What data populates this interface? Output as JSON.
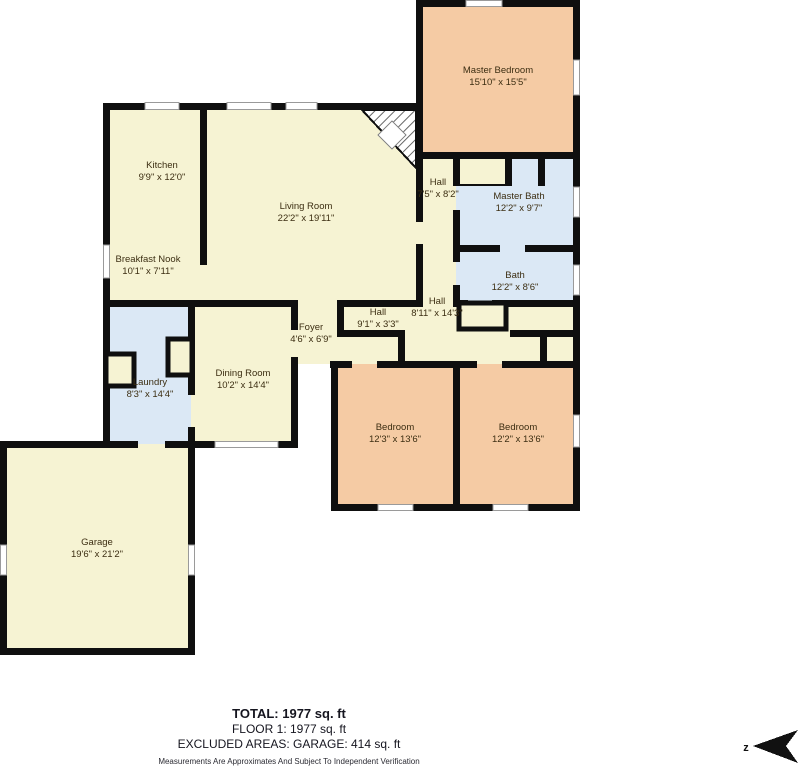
{
  "floorplan": {
    "rooms": [
      {
        "name": "Master Bedroom",
        "dims": "15'10\" x 15'5\""
      },
      {
        "name": "Kitchen",
        "dims": "9'9\" x 12'0\""
      },
      {
        "name": "Living Room",
        "dims": "22'2\" x 19'11\""
      },
      {
        "name": "Breakfast Nook",
        "dims": "10'1\" x 7'11\""
      },
      {
        "name": "Hall",
        "dims": "7'5\" x 8'2\""
      },
      {
        "name": "Master Bath",
        "dims": "12'2\" x 9'7\""
      },
      {
        "name": "Bath",
        "dims": "12'2\" x 8'6\""
      },
      {
        "name": "Hall",
        "dims": "9'1\" x 3'3\""
      },
      {
        "name": "Hall",
        "dims": "8'11\" x 14'3\""
      },
      {
        "name": "Foyer",
        "dims": "4'6\" x 6'9\""
      },
      {
        "name": "Laundry",
        "dims": "8'3\" x 14'4\""
      },
      {
        "name": "Dining Room",
        "dims": "10'2\" x 14'4\""
      },
      {
        "name": "Bedroom",
        "dims": "12'3\" x 13'6\""
      },
      {
        "name": "Bedroom",
        "dims": "12'2\" x 13'6\""
      },
      {
        "name": "Garage",
        "dims": "19'6\" x 21'2\""
      }
    ],
    "summary": {
      "total": "TOTAL: 1977 sq. ft",
      "floor1": "FLOOR 1: 1977 sq. ft",
      "excluded": "EXCLUDED AREAS: GARAGE: 414 sq. ft",
      "disclaimer": "Measurements Are Approximates And Subject To Independent Verification"
    },
    "compass": {
      "label": "z"
    },
    "colors": {
      "room_yellow": "#f6f3d3",
      "room_peach": "#f5cba4",
      "room_blue": "#dbe8f5",
      "wall": "#0f0f0f"
    }
  }
}
